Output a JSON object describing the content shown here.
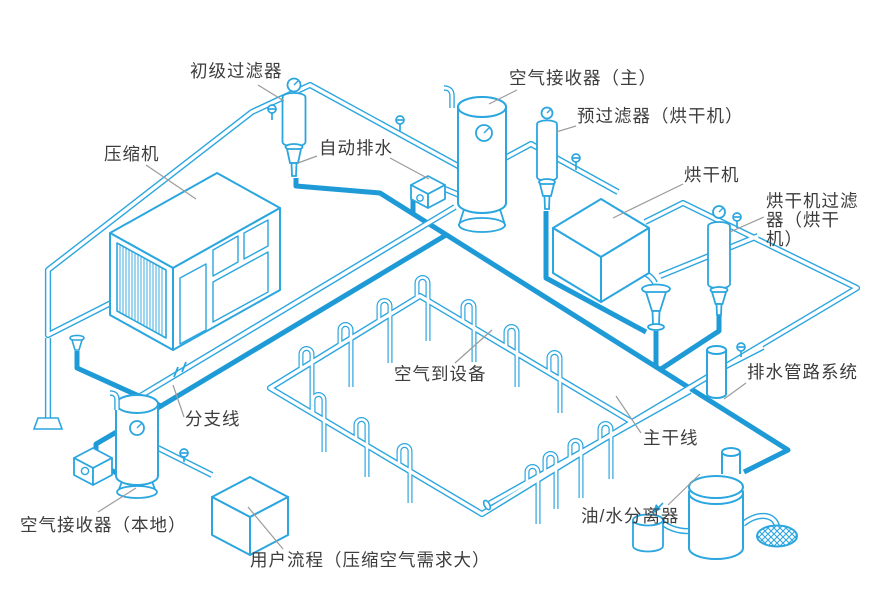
{
  "colors": {
    "pipe_outline": "#2BA6DF",
    "condensate_line": "#1E9AD6",
    "label_text": "#3D3D3D",
    "leader_line": "#9B9B9B",
    "background": "#FFFFFF"
  },
  "labels": [
    {
      "id": "primary-filter",
      "text": "初级过滤器"
    },
    {
      "id": "compressor",
      "text": "压缩机"
    },
    {
      "id": "auto-drain",
      "text": "自动排水"
    },
    {
      "id": "air-receiver-main",
      "text": "空气接收器（主）"
    },
    {
      "id": "pre-filter-dryer",
      "text": "预过滤器（烘干机）"
    },
    {
      "id": "dryer",
      "text": "烘干机"
    },
    {
      "id": "dryer-filter-dryer",
      "text": "烘干机过滤器（烘干机）"
    },
    {
      "id": "air-to-equipment",
      "text": "空气到设备"
    },
    {
      "id": "drain-piping-system",
      "text": "排水管路系统"
    },
    {
      "id": "branch-line",
      "text": "分支线"
    },
    {
      "id": "main-line",
      "text": "主干线"
    },
    {
      "id": "air-receiver-local",
      "text": "空气接收器（本地）"
    },
    {
      "id": "user-process",
      "text": "用户流程（压缩空气需求大）"
    },
    {
      "id": "oil-water-separator",
      "text": "油/水分离器"
    }
  ]
}
